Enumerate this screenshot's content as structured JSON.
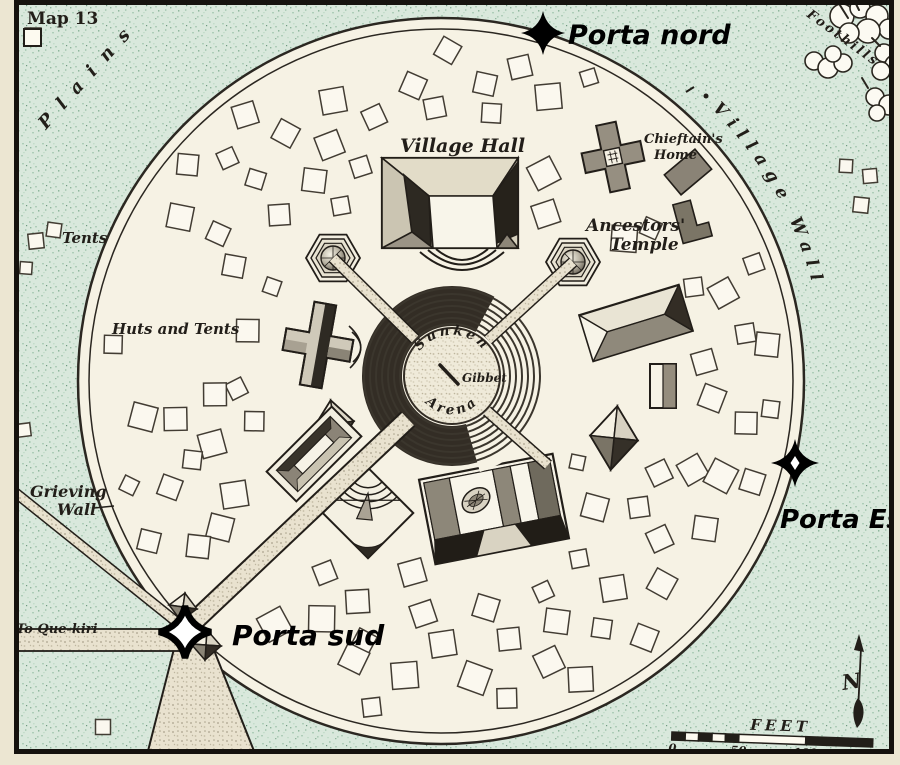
{
  "title": "Map 13",
  "labels": {
    "plains": "Plains",
    "foothills": "Foothills",
    "village_wall": "Village Wall",
    "tents": "Tents",
    "huts_and_tents": "Huts and Tents",
    "grieving_wall_line1": "Grieving",
    "grieving_wall_line2": "Wall",
    "to_que_kiri": "To Que-kiri"
  },
  "features": {
    "village_hall": "Village Hall",
    "chieftains_home_line1": "Chieftain's",
    "chieftains_home_line2": "Home",
    "ancestors_temple_line1": "Ancestors'",
    "ancestors_temple_line2": "Temple",
    "arena_top": "Sunken",
    "arena_bottom": "Arena",
    "gibbet": "Gibbet"
  },
  "gates": {
    "north": "Porta nord",
    "east": "Porta Est",
    "south": "Porta sud"
  },
  "scale_bar": {
    "unit": "FEET",
    "ticks": [
      "0",
      "50",
      "100",
      "150"
    ]
  },
  "compass": {
    "north": "N"
  },
  "colors": {
    "background_green": "#d9e8dc",
    "parchment": "#f6f2e4",
    "ink": "#221e19",
    "building_gray": "#8d8779",
    "annotation_black": "#000000"
  }
}
